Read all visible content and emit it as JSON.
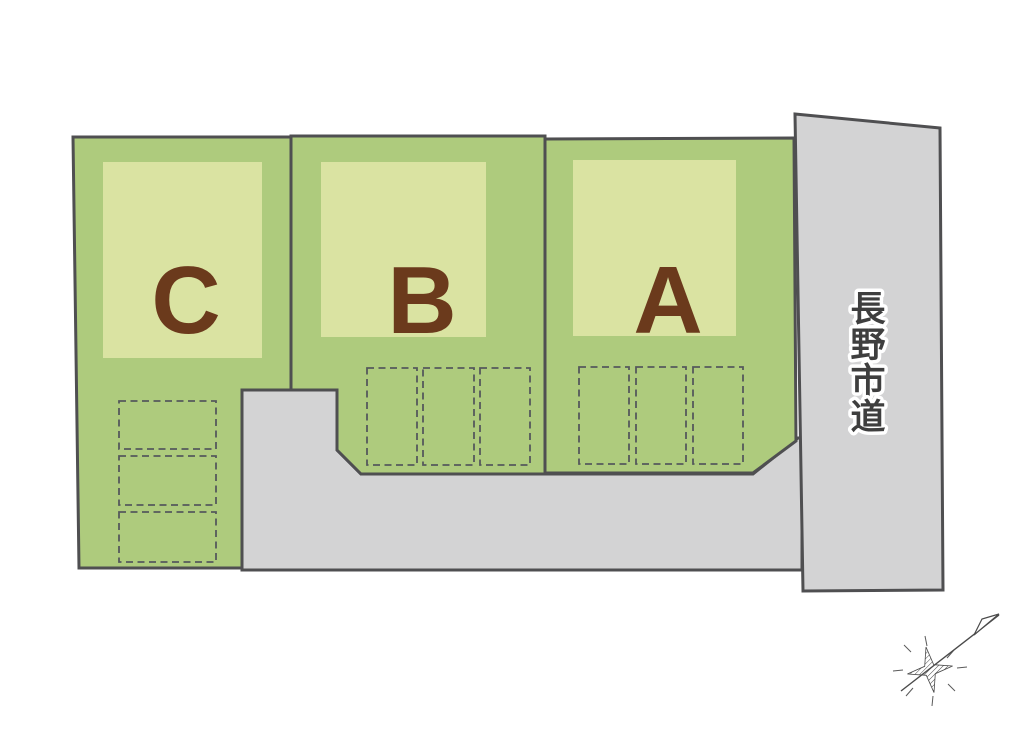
{
  "diagram": {
    "type": "residential-lot-site-plan",
    "lots": [
      {
        "id": "lot-c",
        "label": "C",
        "parking_spaces": 3
      },
      {
        "id": "lot-b",
        "label": "B",
        "parking_spaces": 3
      },
      {
        "id": "lot-a",
        "label": "A",
        "parking_spaces": 3
      }
    ],
    "road": {
      "label": "長野市道",
      "chars": [
        "長",
        "野",
        "市",
        "道"
      ]
    },
    "compass": {
      "icon": "north-arrow-icon"
    },
    "colors": {
      "lot_fill": "#aecb7d",
      "building_fill": "#dae3a2",
      "road_fill": "#d3d3d4",
      "outline": "#4f4f51",
      "lot_label": "#6b3a1c"
    }
  }
}
